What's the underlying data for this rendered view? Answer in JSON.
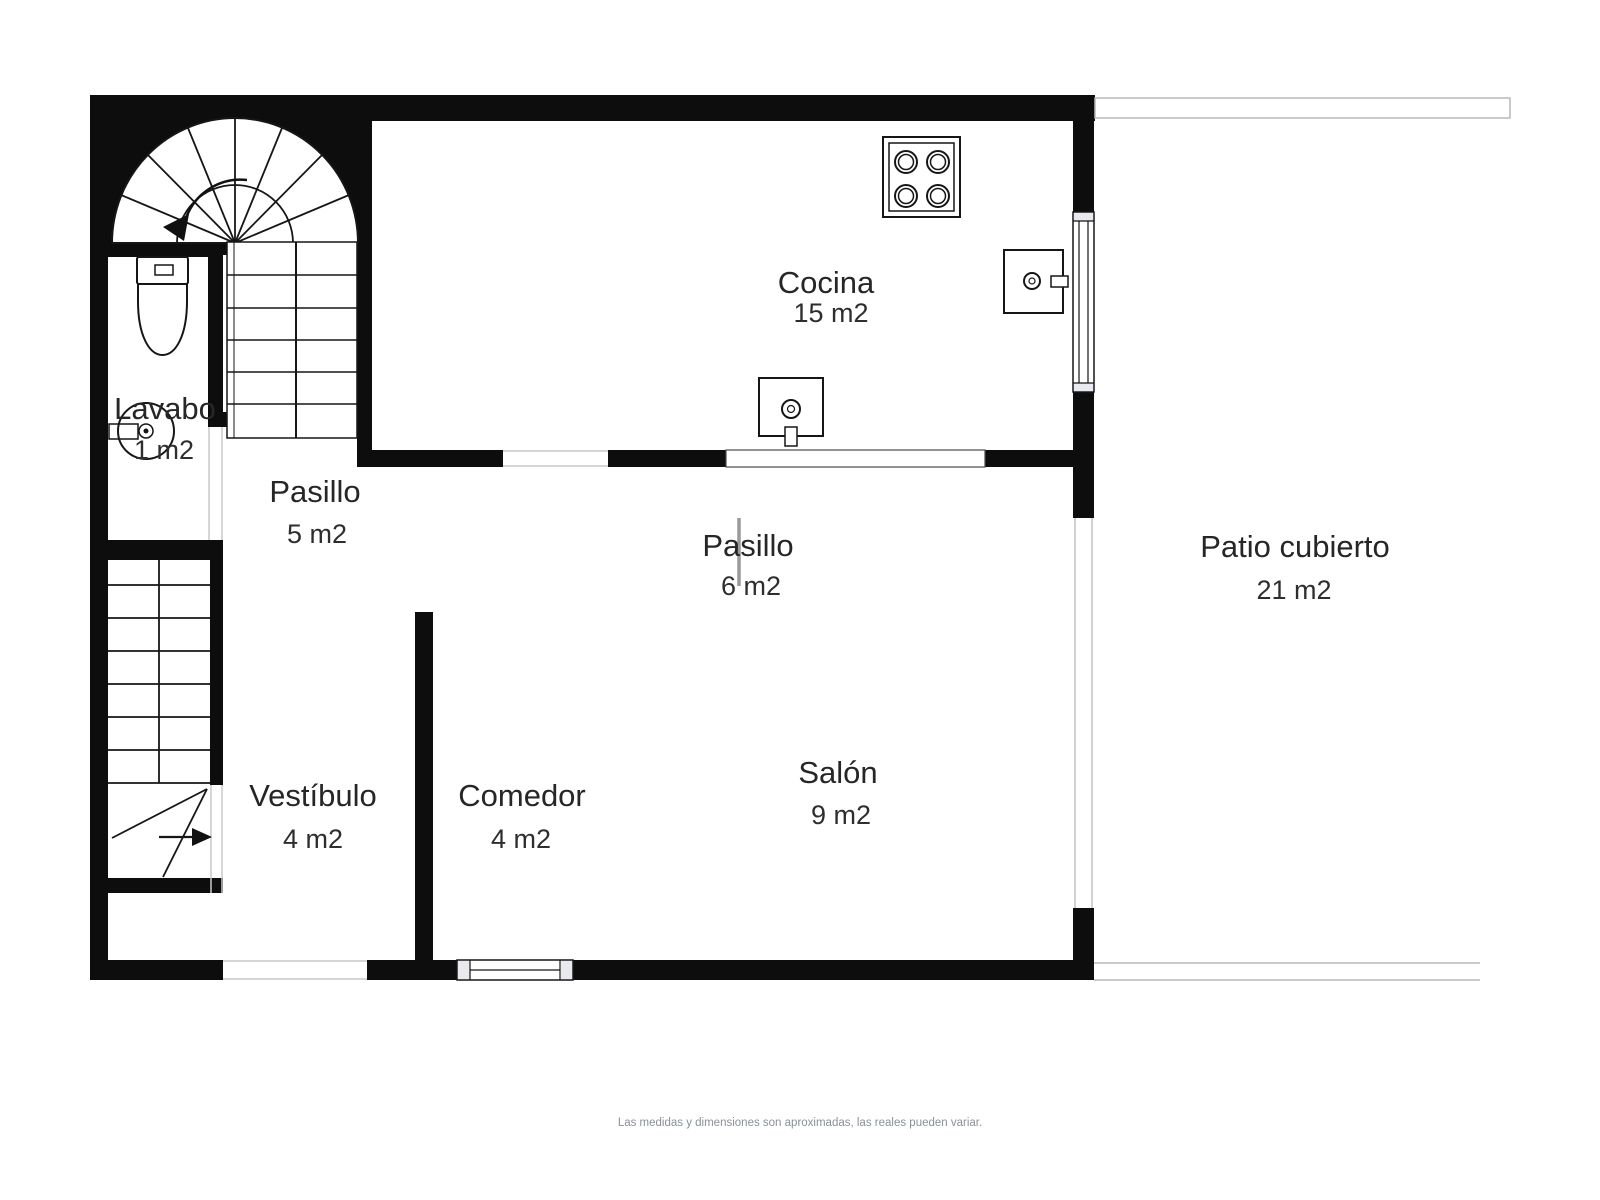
{
  "title": "Plano de planta",
  "colors": {
    "wall": "#0d0d0d",
    "icon_stroke": "#161616",
    "glass": "#c2c2c2",
    "patio_boundary": "#b8b8b8",
    "door_marker": "#9a9a9a",
    "text": "#262626",
    "muted_text": "#8a8f98",
    "background": "#ffffff"
  },
  "rooms": [
    {
      "key": "cocina",
      "name": "Cocina",
      "area": "15 m2"
    },
    {
      "key": "lavabo",
      "name": "Lavabo",
      "area": "1 m2"
    },
    {
      "key": "pasillo-top",
      "name": "Pasillo",
      "area": "5 m2"
    },
    {
      "key": "pasillo-mid",
      "name": "Pasillo",
      "area": "6 m2"
    },
    {
      "key": "patio",
      "name": "Patio cubierto",
      "area": "21 m2"
    },
    {
      "key": "vestibulo",
      "name": "Vestíbulo",
      "area": "4 m2"
    },
    {
      "key": "comedor",
      "name": "Comedor",
      "area": "4 m2"
    },
    {
      "key": "salon",
      "name": "Salón",
      "area": "9 m2"
    }
  ],
  "fixtures": [
    "spiral-staircase",
    "straight-staircase-upper",
    "staircase-lower",
    "toilet",
    "lavabo-sink",
    "stove-4-burners",
    "kitchen-island-sink",
    "kitchen-wall-sink",
    "window-right-wall",
    "window-bottom-wall",
    "kitchen-pass-opening",
    "glass-opening-patio"
  ],
  "footer": {
    "note": "Las medidas y dimensiones son aproximadas, las reales pueden variar."
  }
}
